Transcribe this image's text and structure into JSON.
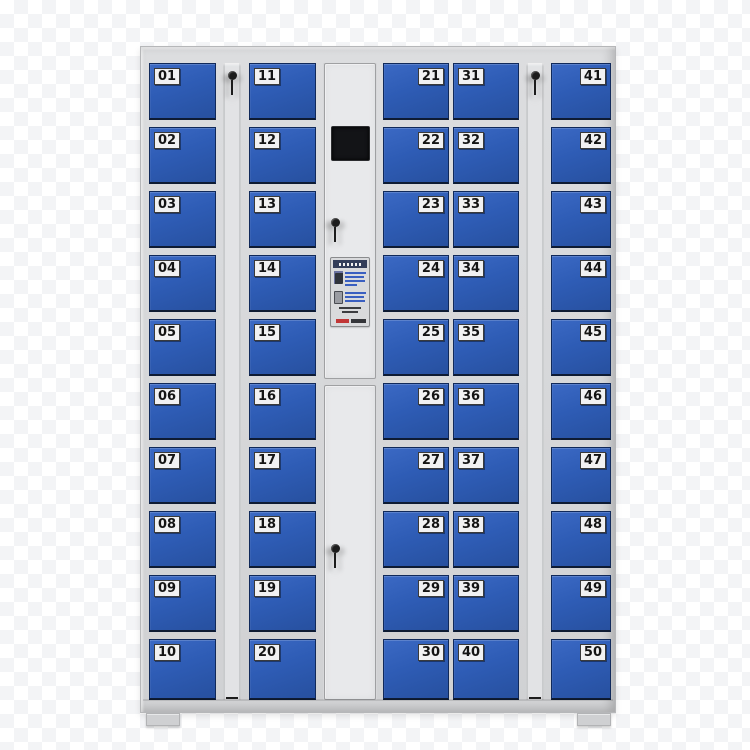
{
  "scene": {
    "description_label": "",
    "door_count": 50
  },
  "icons": {
    "key_strip_left": "key-icon",
    "key_strip_right": "key-icon",
    "panel_upper_lock": "key-icon",
    "panel_lower_lock": "key-icon"
  },
  "cabinet": {
    "colors": {
      "frame": "#d6d7d9",
      "frame_edge": "#b6b7b9",
      "strip": "#e2e3e5",
      "strip_edge": "#c7c8ca",
      "panel": "#e8e9eb",
      "panel_edge": "#9fa0a2",
      "door_blue": "#2e5cb5",
      "door_blue_light": "#3b69c4",
      "door_blue_dark": "#27509f",
      "door_border": "#10295a",
      "door_bottom": "#0e1b33",
      "plate": "#f1f1f2",
      "plate_text": "#141414",
      "screen": "#131417",
      "key": "#1c1c1c",
      "sticker_bg": "#d9dadc",
      "sticker_header": "#333e5a",
      "sticker_line": "#3a5fc0",
      "sticker_dark": "#30343c",
      "sticker_red": "#c13636",
      "foot": "#cfd0d2",
      "bg_checker": "#f3f4f6"
    },
    "columns": [
      {
        "kind": "doors",
        "name": "column-1",
        "label_side": "left",
        "doors": [
          "01",
          "02",
          "03",
          "04",
          "05",
          "06",
          "07",
          "08",
          "09",
          "10"
        ]
      },
      {
        "kind": "keystrip",
        "name": "key-strip-left"
      },
      {
        "kind": "doors",
        "name": "column-2",
        "label_side": "left",
        "doors": [
          "11",
          "12",
          "13",
          "14",
          "15",
          "16",
          "17",
          "18",
          "19",
          "20"
        ]
      },
      {
        "kind": "panel",
        "name": "control-panel"
      },
      {
        "kind": "doors",
        "name": "column-3",
        "label_side": "right",
        "doors": [
          "21",
          "22",
          "23",
          "24",
          "25",
          "26",
          "27",
          "28",
          "29",
          "30"
        ]
      },
      {
        "kind": "doors",
        "name": "column-4",
        "label_side": "left",
        "doors": [
          "31",
          "32",
          "33",
          "34",
          "35",
          "36",
          "37",
          "38",
          "39",
          "40"
        ]
      },
      {
        "kind": "keystrip",
        "name": "key-strip-right"
      },
      {
        "kind": "doors",
        "name": "column-5",
        "label_side": "right",
        "doors": [
          "41",
          "42",
          "43",
          "44",
          "45",
          "46",
          "47",
          "48",
          "49",
          "50"
        ]
      }
    ]
  }
}
